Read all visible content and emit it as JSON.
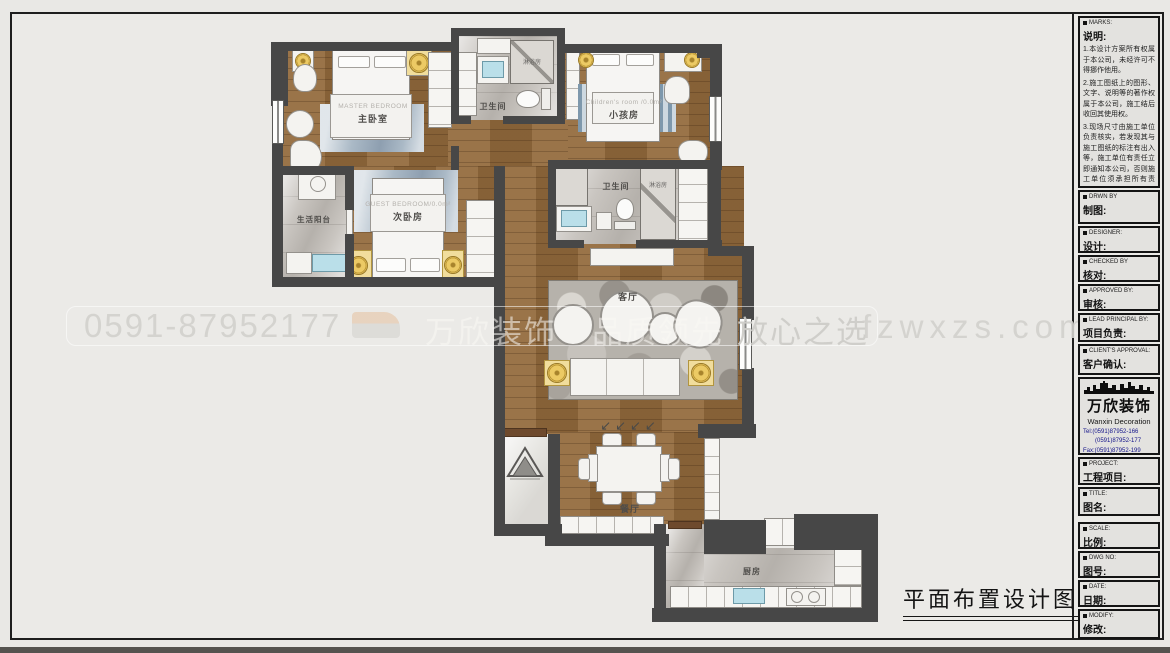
{
  "watermark": {
    "phone": "0591-87952177",
    "brand": "万欣装饰",
    "slogan_a": "品质领先",
    "slogan_b": "放心之选",
    "site": "fzwxzs.com"
  },
  "drawing_title": "平面布置设计图",
  "rooms": {
    "master": {
      "en": "MASTER  BEDROOM",
      "zh": "主卧室"
    },
    "bath1": {
      "zh": "卫生间"
    },
    "shower1": {
      "zh": "淋浴房"
    },
    "children": {
      "en": "Children's  room /0.0m²",
      "zh": "小孩房"
    },
    "guest": {
      "en": "GUEST  BEDROOM/0.0m²",
      "zh": "次卧房"
    },
    "balcony": {
      "zh": "生活阳台"
    },
    "bath2": {
      "zh": "卫生间"
    },
    "shower2": {
      "zh": "淋浴房"
    },
    "living": {
      "zh": "客厅"
    },
    "dining": {
      "zh": "餐厅"
    },
    "kitchen": {
      "zh": "厨房"
    }
  },
  "titleblock": {
    "marks": {
      "en": "MARKS:",
      "zh": "说明:"
    },
    "notes": [
      "1.本设计方案所有权属于本公司，未经许可不得挪作他用。",
      "2.施工图纸上的图形、文字、说明等的著作权属于本公司，施工结后收回其使用权。",
      "3.现场尺寸由施工单位负责核实，若发现其与施工图纸的标注有出入等，施工单位有责任立即通知本公司，否则施工单位须承担所有责任。",
      "4.本设计方案是按客户要求设计，经客户签字即视为同意认可，不得随意更改。"
    ],
    "fields": [
      {
        "en": "DRWN BY",
        "zh": "制图:"
      },
      {
        "en": "DESIGNER:",
        "zh": "设计:"
      },
      {
        "en": "CHECKED BY",
        "zh": "核对:"
      },
      {
        "en": "APPROVED BY:",
        "zh": "审核:"
      },
      {
        "en": "LEAD PRINCIPAL BY:",
        "zh": "项目负责:"
      },
      {
        "en": "CLIENT'S APPROVAL:",
        "zh": "客户确认:"
      }
    ],
    "logo": {
      "brand_zh": "万欣装饰",
      "brand_en": "Wanxin Decoration",
      "tel1": "Tel:(0591)87952-166",
      "tel2": "(0591)87952-177",
      "fax": "Fax:(0591)87952-199",
      "web": "Web:WWW.fzwxzs.com"
    },
    "fields2": [
      {
        "en": "PROJECT:",
        "zh": "工程项目:"
      },
      {
        "en": "TITLE:",
        "zh": "图名:"
      },
      {
        "en": "SCALE:",
        "zh": "比例:"
      },
      {
        "en": "DWG NO:",
        "zh": "图号:"
      },
      {
        "en": "DATE:",
        "zh": "日期:"
      },
      {
        "en": "MODIFY:",
        "zh": "修改:"
      }
    ]
  }
}
